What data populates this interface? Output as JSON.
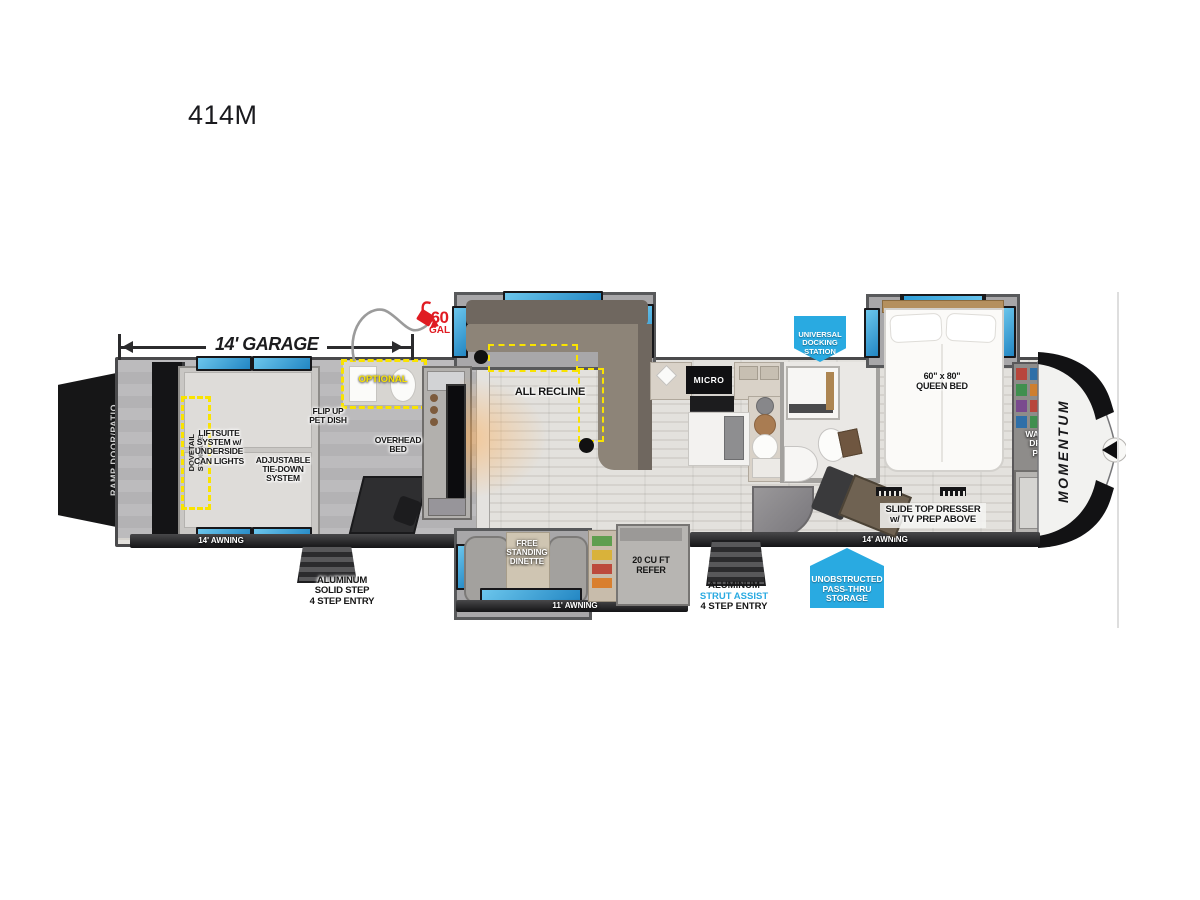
{
  "title": "414M",
  "colors": {
    "accent_blue": "#29aae1",
    "alert_red": "#e01b22",
    "optional_yellow": "#f9e300",
    "window_blue": "#2f9fd8"
  },
  "labels": {
    "garage_dimension": "14' GARAGE",
    "fuel_value": "60",
    "fuel_unit": "GAL",
    "ramp_door": "RAMP DOOR/PATIO",
    "dovetail_storage": "DOVETAIL\nSTORAGE",
    "liftsuite": "LIFTSUITE\nSYSTEM w/\nUNDERSIDE\nCAN LIGHTS",
    "tie_down": "ADJUSTABLE\nTIE-DOWN\nSYSTEM",
    "pet_dish": "FLIP UP\nPET DISH",
    "overhead_bed": "OVERHEAD\nBED",
    "optional_bath": "OPTIONAL",
    "all_recline": "ALL RECLINE",
    "micro": "MICRO",
    "queen_bed": "60\" x 80\"\nQUEEN BED",
    "docking_station": "UNIVERSAL\nDOCKING\nSTATION",
    "washer_dryer": "WASHER\nDRYER\nPREP",
    "brand": "MOMENTUM",
    "dresser": "SLIDE TOP DRESSER\nw/ TV PREP ABOVE",
    "awning_garage": "14' AWNING",
    "awning_main": "14' AWNING",
    "awning_dinette": "11' AWNING",
    "dinette": "FREE\nSTANDING\nDINETTE",
    "refrigerator": "20 CU FT\nREFER",
    "step_garage": "ALUMINUM\nSOLID STEP\n4 STEP ENTRY",
    "step_main_1": "ALUMINUM",
    "step_main_2": "STRUT ASSIST",
    "step_main_3": "4 STEP ENTRY",
    "pass_thru": "UNOBSTRUCTED\nPASS-THRU\nSTORAGE"
  }
}
